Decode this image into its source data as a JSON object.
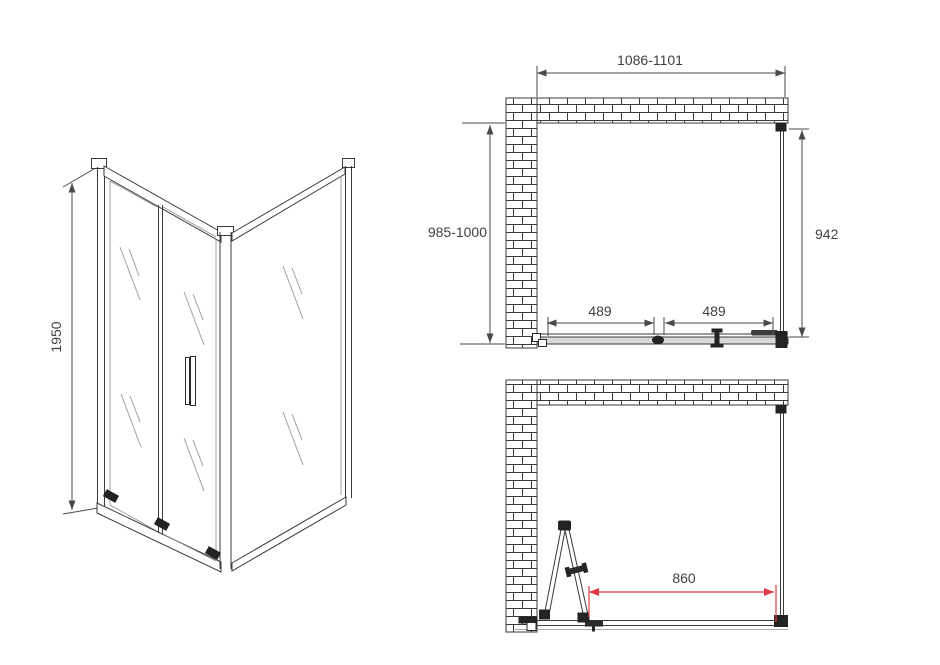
{
  "drawing": {
    "type": "shower-enclosure-technical-drawing",
    "colors": {
      "line": "#3a3a3a",
      "dim_text": "#3f3f3f",
      "accent_red": "#e23a44",
      "track_fill": "#d9d9d9",
      "hardware": "#232323"
    },
    "front_view": {
      "height": "1950"
    },
    "plan_top": {
      "width_range": "1086-1101",
      "depth_range": "985-1000",
      "side_panel": "942",
      "door_panel_left": "489",
      "door_panel_right": "489"
    },
    "plan_bottom": {
      "door_opening": "860"
    }
  }
}
